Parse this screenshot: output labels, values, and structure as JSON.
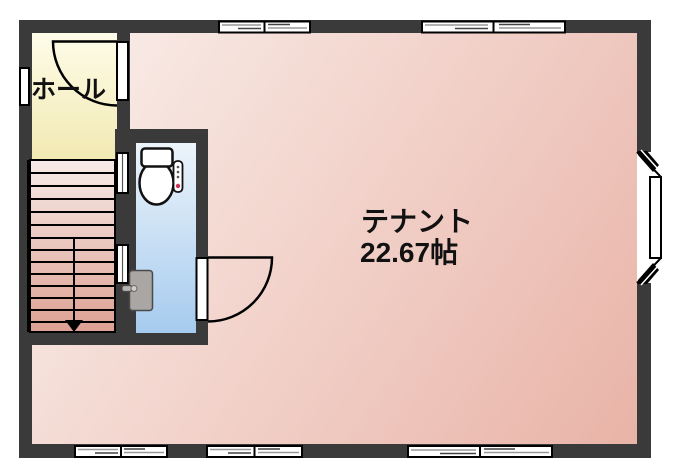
{
  "floorplan": {
    "labels": {
      "hall": "ホール",
      "tenant_name": "テナント",
      "tenant_size": "22.67帖"
    },
    "colors": {
      "wall": "#3a3a3a",
      "outline": "#000000",
      "window_fill": "#ffffff",
      "hall_light": "#fefce9",
      "hall_dark": "#f2e9b2",
      "tenant_light": "#faf0ec",
      "tenant_dark": "#e9b3a7",
      "toilet_light": "#ecf4fb",
      "toilet_dark": "#a6cbee",
      "stairs_light": "#f7ebe7",
      "stairs_dark": "#dda093",
      "door_panel": "#a9a6a3",
      "alert_dot": "#cc3355"
    }
  }
}
